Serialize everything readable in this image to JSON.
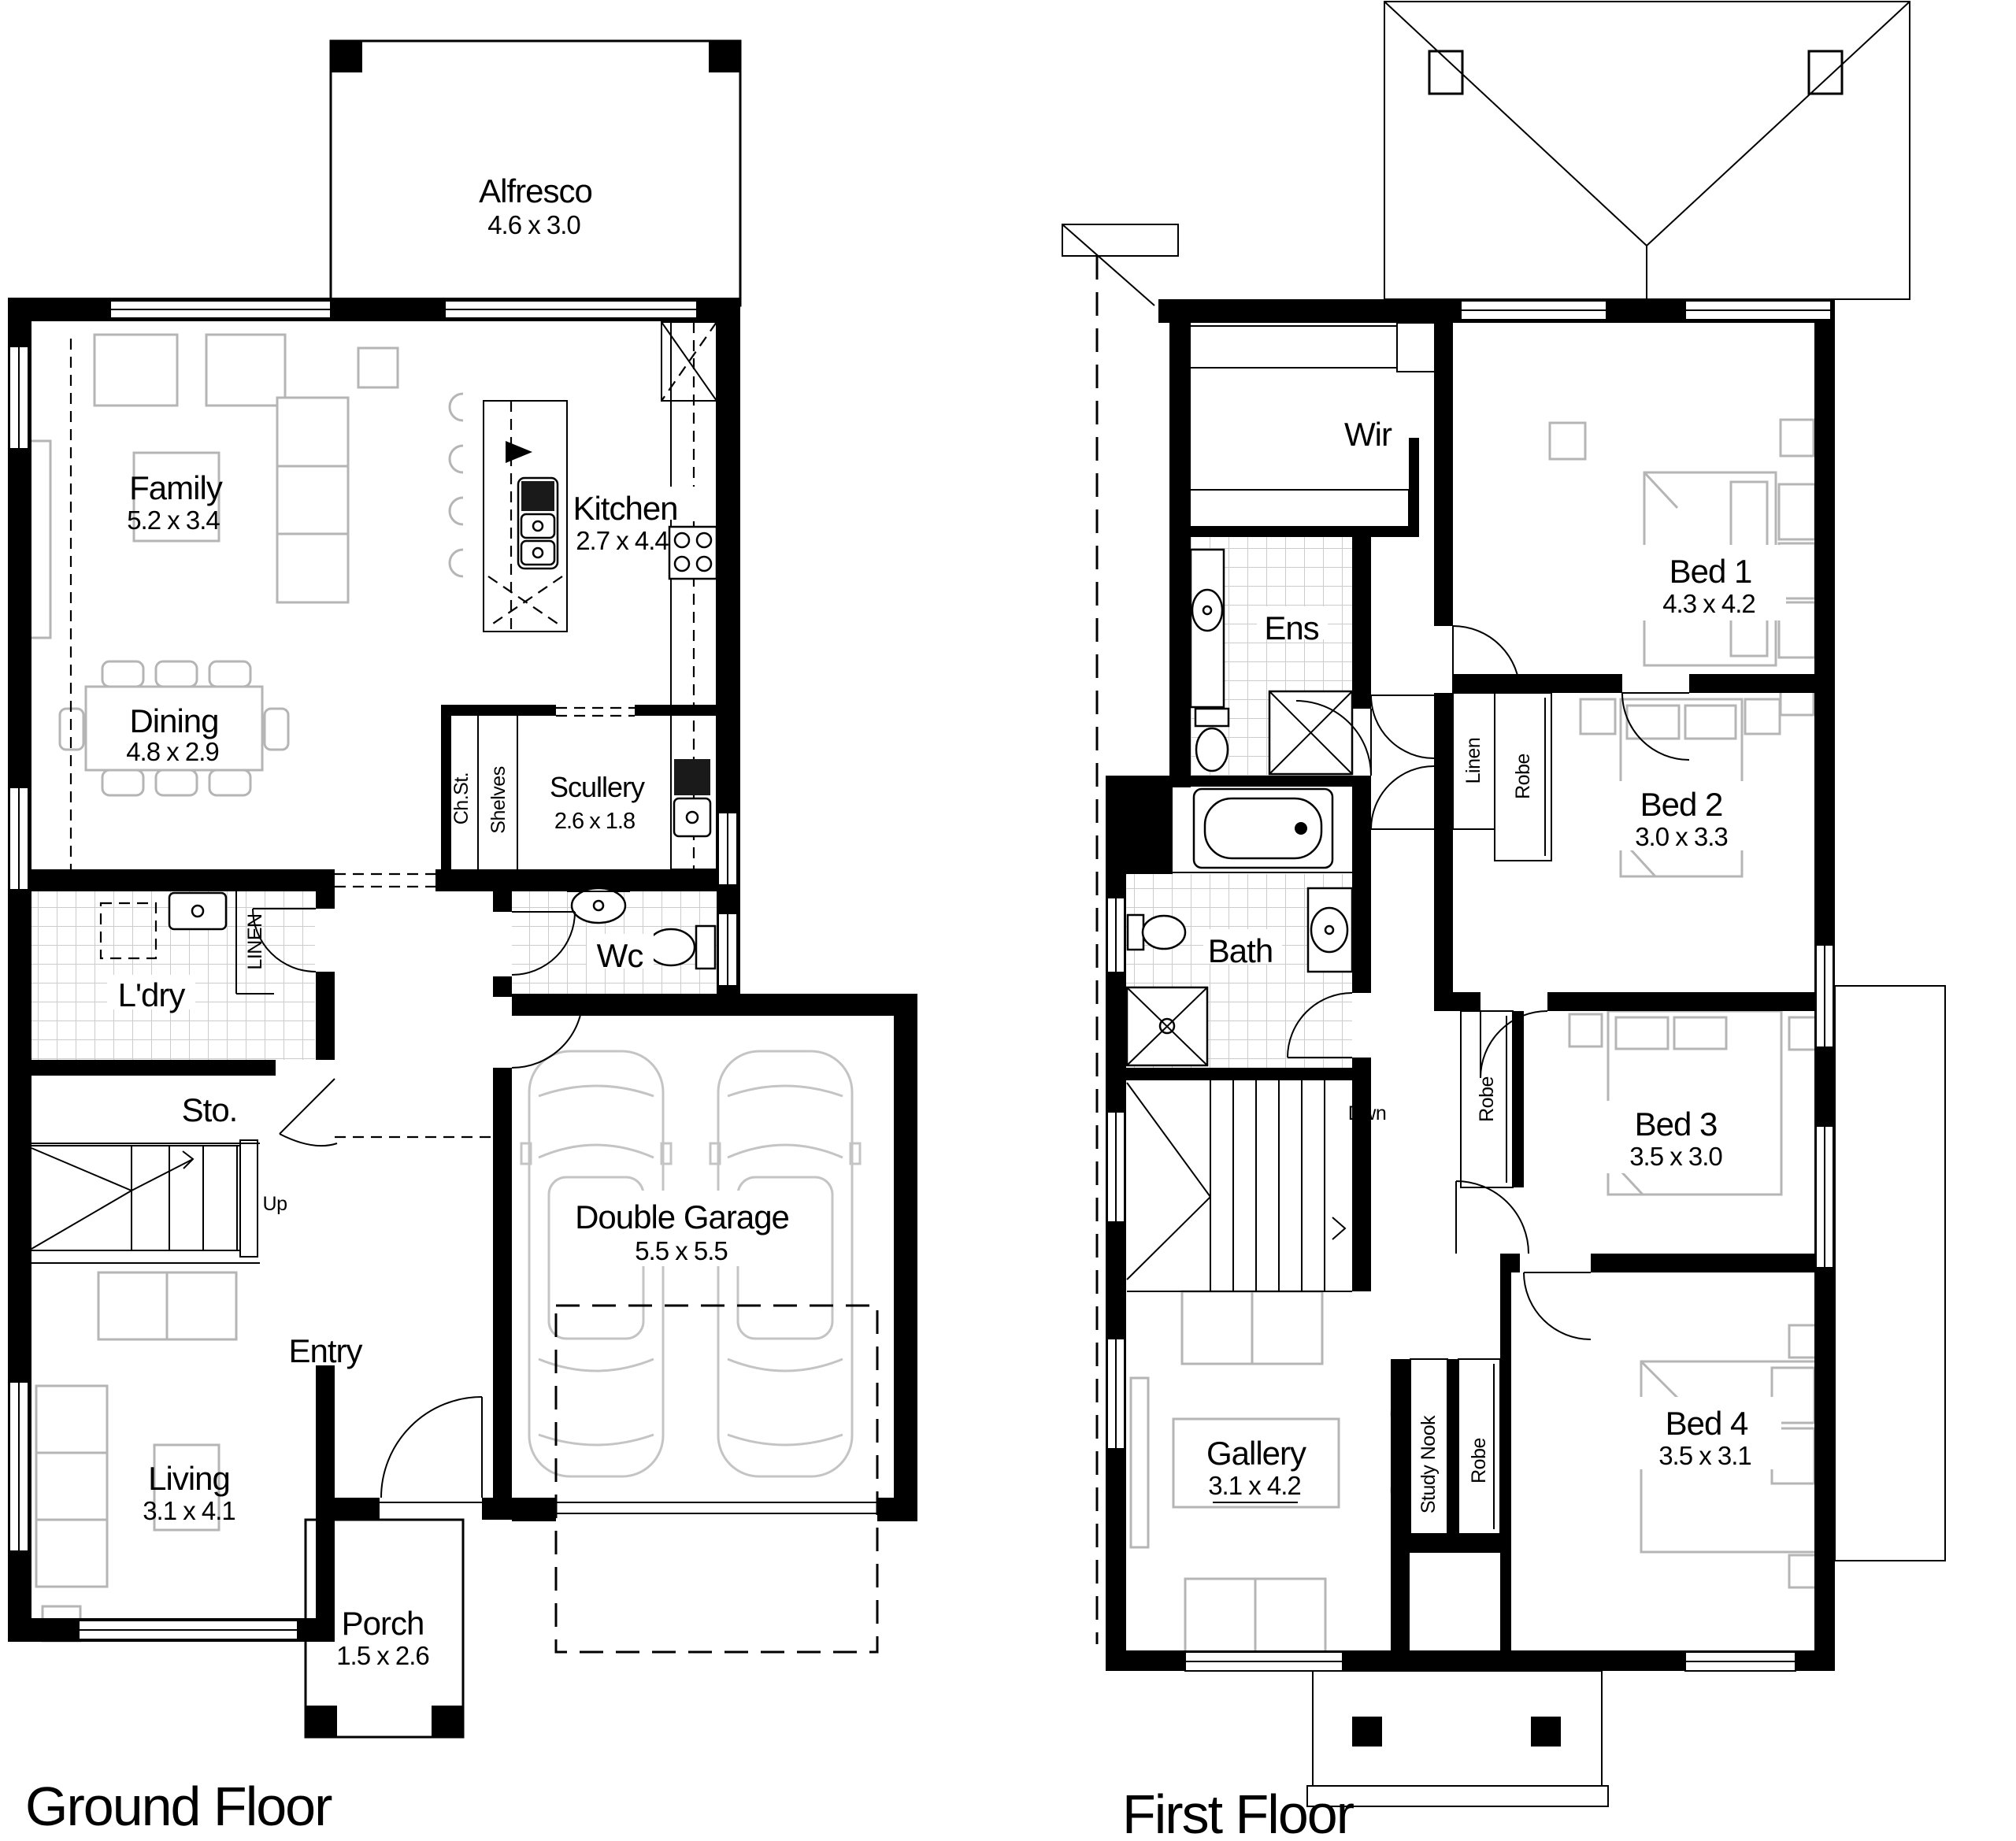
{
  "document": {
    "type": "architectural-floor-plan",
    "background": "#ffffff"
  },
  "colors": {
    "wall": "#000000",
    "furniture_line": "#b5b5b5",
    "car_line": "#c4c4c4",
    "tile_line": "#cccccc",
    "text": "#000000"
  },
  "titles": {
    "ground": "Ground Floor",
    "first": "First Floor"
  },
  "ground": {
    "rooms": {
      "alfresco": {
        "name": "Alfresco",
        "dims": "4.6 x 3.0"
      },
      "family": {
        "name": "Family",
        "dims": "5.2 x 3.4"
      },
      "kitchen": {
        "name": "Kitchen",
        "dims": "2.7 x 4.4"
      },
      "dining": {
        "name": "Dining",
        "dims": "4.8 x 2.9"
      },
      "scullery": {
        "name": "Scullery",
        "dims": "2.6 x 1.8"
      },
      "wc": {
        "name": "Wc"
      },
      "ldry": {
        "name": "L'dry"
      },
      "sto": {
        "name": "Sto."
      },
      "entry": {
        "name": "Entry"
      },
      "living": {
        "name": "Living",
        "dims": "3.1 x 4.1"
      },
      "porch": {
        "name": "Porch",
        "dims": "1.5 x 2.6"
      },
      "garage": {
        "name": "Double Garage",
        "dims": "5.5 x 5.5"
      }
    },
    "labels": {
      "chst": "Ch.St.",
      "shelves": "Shelves",
      "linen": "LINEN",
      "up": "Up"
    }
  },
  "first": {
    "rooms": {
      "wir": {
        "name": "Wir"
      },
      "bed1": {
        "name": "Bed 1",
        "dims": "4.3 x 4.2"
      },
      "ens": {
        "name": "Ens"
      },
      "bed2": {
        "name": "Bed 2",
        "dims": "3.0 x 3.3"
      },
      "bath": {
        "name": "Bath"
      },
      "bed3": {
        "name": "Bed 3",
        "dims": "3.5 x 3.0"
      },
      "bed4": {
        "name": "Bed 4",
        "dims": "3.5 x 3.1"
      },
      "gallery": {
        "name": "Gallery",
        "dims": "3.1 x 4.2"
      }
    },
    "labels": {
      "dwn": "Dwn",
      "linen": "Linen",
      "robe_bed2": "Robe",
      "robe_bed3": "Robe",
      "robe_bed4": "Robe",
      "study": "Study Nook"
    }
  }
}
